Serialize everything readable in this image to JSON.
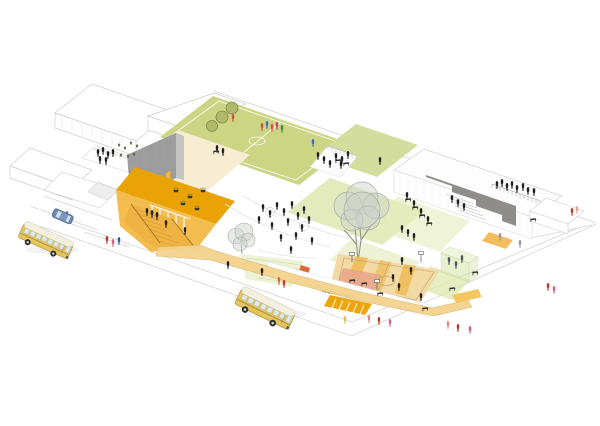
{
  "document": {
    "type": "architectural axonometric site illustration",
    "title": "Middle school campus plaza - axonometric view"
  },
  "labels": {
    "building_sign": "middle school"
  },
  "palette": {
    "background": "#ffffff",
    "line_gray": "#d4d4d4",
    "wire_gray": "#cccccc",
    "facade_gray": "#9d9d9d",
    "facade_side": "#c4c4c4",
    "parapet_gray": "#8f8d89",
    "arch_amber": "#e9b64d",
    "plaza_orange_deep": "#eaa307",
    "plaza_orange_light": "#f2bd4e",
    "stair_orange": "#f0b243",
    "promenade_amber": "#f4d28c",
    "crossing_orange": "#eea50c",
    "cream": "#f8ecd2",
    "field_green": "#ccd584",
    "field_tree_green": "#aeb96a",
    "field_tree_ring": "#7d8748",
    "green_roof": "#d3dd9e",
    "lawn_green": "#dce6ab",
    "canopy_green": "#dfe8b0",
    "glass_green": "#d4e3a6",
    "tree_canopy_gray": "#cdd0cd",
    "tree_line_gray": "#a8aba8",
    "trunk_gray": "#8f928f",
    "court_tan": "#f3d9a4",
    "court_stripe": "#ecb54e",
    "court_pink": "#e8a78c",
    "slide_red": "#d96a35",
    "bus_yellow": "#e6c45c",
    "bus_roof": "#f3efdf",
    "window_blue": "#d9eaf3",
    "car_blue": "#6b87b0",
    "figure_black": "#1f1f1f",
    "sign_text": "#3f3428"
  },
  "scene": {
    "figures": [
      [
        263,
        209
      ],
      [
        270,
        215
      ],
      [
        277,
        207
      ],
      [
        284,
        213
      ],
      [
        292,
        206
      ],
      [
        298,
        217
      ],
      [
        288,
        223
      ],
      [
        272,
        227
      ],
      [
        302,
        229
      ],
      [
        309,
        221
      ],
      [
        296,
        237
      ],
      [
        281,
        239
      ],
      [
        312,
        242
      ],
      [
        259,
        221
      ],
      [
        304,
        211
      ],
      [
        291,
        251
      ],
      [
        185,
        232
      ],
      [
        166,
        225
      ],
      [
        98,
        154
      ],
      [
        103,
        152
      ],
      [
        108,
        156
      ],
      [
        113,
        154
      ],
      [
        100,
        161
      ],
      [
        106,
        162
      ],
      [
        147,
        213
      ],
      [
        152,
        215
      ],
      [
        157,
        217
      ],
      [
        217,
        150
      ],
      [
        223,
        153
      ],
      [
        318,
        157
      ],
      [
        324,
        161
      ],
      [
        330,
        165
      ],
      [
        336,
        158
      ],
      [
        342,
        161
      ],
      [
        348,
        156
      ],
      [
        341,
        166
      ],
      [
        380,
        162
      ],
      [
        497,
        186
      ],
      [
        502,
        184
      ],
      [
        507,
        188
      ],
      [
        512,
        186
      ],
      [
        517,
        190
      ],
      [
        523,
        188
      ],
      [
        528,
        192
      ],
      [
        534,
        193
      ],
      [
        452,
        200
      ],
      [
        458,
        204
      ],
      [
        464,
        208
      ],
      [
        407,
        197
      ],
      [
        414,
        205
      ],
      [
        421,
        213
      ],
      [
        428,
        221
      ],
      [
        402,
        230
      ],
      [
        408,
        234
      ],
      [
        414,
        238
      ],
      [
        449,
        262,
        "#555555"
      ],
      [
        456,
        266,
        "#555555"
      ],
      [
        462,
        260,
        "#555555"
      ],
      [
        402,
        262
      ],
      [
        411,
        272
      ],
      [
        393,
        279
      ],
      [
        399,
        288
      ],
      [
        421,
        298
      ],
      [
        279,
        282,
        "#d96a35"
      ],
      [
        284,
        285,
        "#c0392b"
      ],
      [
        228,
        266
      ],
      [
        262,
        273
      ],
      [
        107,
        241,
        "#b03a2e"
      ],
      [
        113,
        244,
        "#d95f8a"
      ],
      [
        119,
        242,
        "#2f5a9e"
      ],
      [
        62,
        218,
        "#b03a2e"
      ],
      [
        67,
        216,
        "#5b7fae"
      ],
      [
        345,
        321,
        "#e8b84b"
      ],
      [
        369,
        320,
        "#d98a7a"
      ],
      [
        379,
        322,
        "#c0392b"
      ],
      [
        390,
        324,
        "#d95f8a"
      ],
      [
        448,
        326,
        "#d98a7a"
      ],
      [
        458,
        329,
        "#b03a2e"
      ],
      [
        470,
        331,
        "#d95f8a"
      ],
      [
        548,
        288,
        "#c0392b"
      ],
      [
        554,
        291,
        "#d95f8a"
      ],
      [
        572,
        213,
        "#c0392b"
      ],
      [
        577,
        211,
        "#e8a0a0"
      ],
      [
        500,
        238,
        "#9a9a9a"
      ],
      [
        520,
        245,
        "#9a9a9a"
      ],
      [
        262,
        128,
        "#d94f3e"
      ],
      [
        267,
        126,
        "#3f6fb5"
      ],
      [
        272,
        129,
        "#d94f3e"
      ],
      [
        277,
        127,
        "#c9427e"
      ],
      [
        282,
        130,
        "#4a8a3c"
      ],
      [
        233,
        119,
        "#d94f3e"
      ],
      [
        313,
        144,
        "#3f6fb5"
      ]
    ],
    "desks": [
      [
        533,
        220
      ],
      [
        475,
        273
      ],
      [
        452,
        289
      ],
      [
        425,
        309
      ],
      [
        352,
        281
      ],
      [
        364,
        284
      ],
      [
        380,
        294
      ],
      [
        338,
        161
      ],
      [
        346,
        164
      ],
      [
        216,
        152
      ],
      [
        408,
        200
      ],
      [
        415,
        208
      ],
      [
        422,
        216
      ],
      [
        429,
        224
      ]
    ],
    "planters": [
      [
        176,
        190
      ],
      [
        190,
        196
      ],
      [
        203,
        190
      ],
      [
        183,
        203
      ],
      [
        197,
        208
      ]
    ],
    "roof_plants": [
      [
        119,
        147
      ],
      [
        125,
        150
      ],
      [
        131,
        145
      ],
      [
        137,
        148
      ],
      [
        121,
        157
      ],
      [
        128,
        158
      ],
      [
        134,
        156
      ]
    ],
    "field_trees": [
      [
        232,
        108,
        6
      ],
      [
        222,
        117,
        6
      ],
      [
        212,
        126,
        5.5
      ]
    ]
  }
}
